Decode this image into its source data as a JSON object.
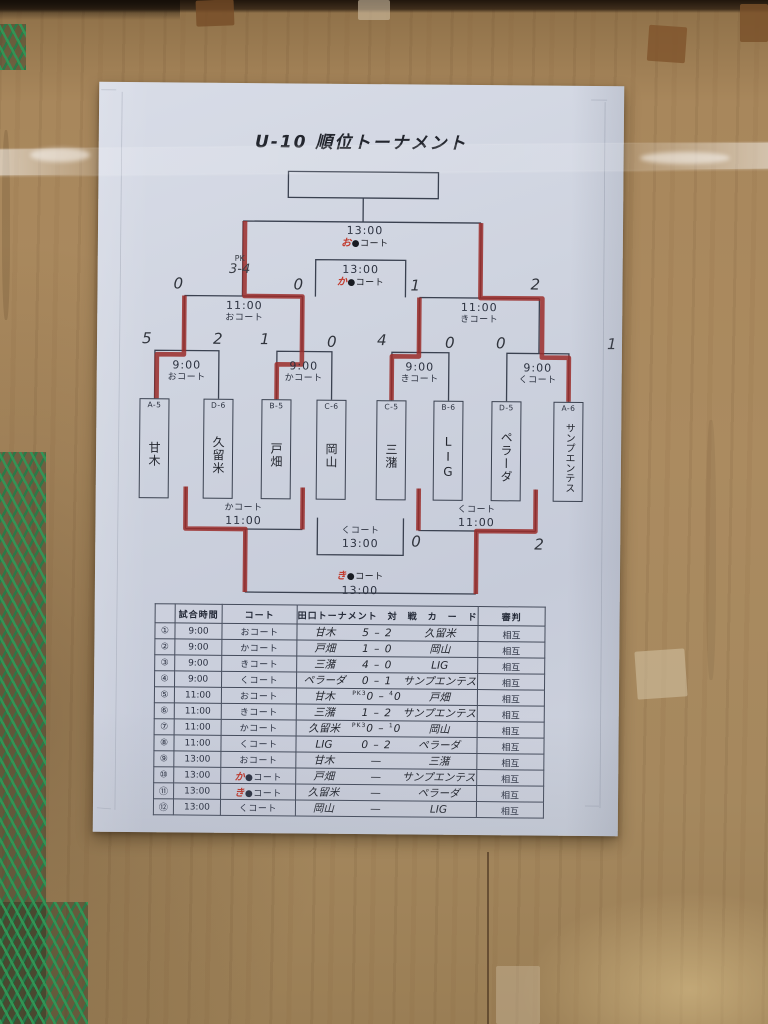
{
  "title": "U-10  順位トーナメント",
  "bracket": {
    "final": {
      "time": "13:00",
      "court_red": "お",
      "court_rest": "●コート"
    },
    "third_place": {
      "time": "13:00",
      "court_red": "か",
      "court_rest": "●コート"
    },
    "semi_left": {
      "time": "11:00",
      "court": "おコート",
      "score_left": "0",
      "score_right": "0",
      "pk_line1": "PK",
      "pk_line2": "3-4"
    },
    "semi_right": {
      "time": "11:00",
      "court": "きコート",
      "score_left": "1",
      "score_right": "2"
    },
    "qf1": {
      "time": "9:00",
      "court": "おコート",
      "score_left": "5",
      "score_right": "2"
    },
    "qf2": {
      "time": "9:00",
      "court": "かコート",
      "score_left": "1",
      "score_right": "0"
    },
    "qf3": {
      "time": "9:00",
      "court": "きコート",
      "score_left": "4",
      "score_right": "0"
    },
    "qf4": {
      "time": "9:00",
      "court": "くコート",
      "score_left": "0",
      "score_right": "1"
    },
    "consolation_left": {
      "court": "かコート",
      "time": "11:00"
    },
    "consolation_right": {
      "court": "くコート",
      "time": "11:00",
      "score_left": "0",
      "score_right": "2"
    },
    "seventh_place": {
      "court": "くコート",
      "time": "13:00"
    },
    "fifth_place": {
      "court_red": "き",
      "court_rest": "●コート",
      "time": "13:00"
    },
    "teams": [
      {
        "seed": "A-5",
        "name": "甘木"
      },
      {
        "seed": "D-6",
        "name": "久留米"
      },
      {
        "seed": "B-5",
        "name": "戸畑"
      },
      {
        "seed": "C-6",
        "name": "岡山"
      },
      {
        "seed": "C-5",
        "name": "三潴"
      },
      {
        "seed": "B-6",
        "name": "LIG"
      },
      {
        "seed": "D-5",
        "name": "ペラーダ"
      },
      {
        "seed": "A-6",
        "name": "サンプエンテス"
      }
    ]
  },
  "table": {
    "headers": {
      "no": "",
      "time": "試合時間",
      "court": "コート",
      "card": "田口トーナメント　対　戦　カ　ー　ド",
      "referee": "審判"
    },
    "rows": [
      {
        "no": "①",
        "time": "9:00",
        "court_red": "",
        "court": "おコート",
        "home": "甘木",
        "pk_home": "",
        "score_home": "5",
        "score_away": "2",
        "pk_away": "",
        "away": "久留米",
        "referee": "相互"
      },
      {
        "no": "②",
        "time": "9:00",
        "court_red": "",
        "court": "かコート",
        "home": "戸畑",
        "pk_home": "",
        "score_home": "1",
        "score_away": "0",
        "pk_away": "",
        "away": "岡山",
        "referee": "相互"
      },
      {
        "no": "③",
        "time": "9:00",
        "court_red": "",
        "court": "きコート",
        "home": "三潴",
        "pk_home": "",
        "score_home": "4",
        "score_away": "0",
        "pk_away": "",
        "away": "LIG",
        "referee": "相互"
      },
      {
        "no": "④",
        "time": "9:00",
        "court_red": "",
        "court": "くコート",
        "home": "ペラーダ",
        "pk_home": "",
        "score_home": "0",
        "score_away": "1",
        "pk_away": "",
        "away": "サンプエンテス",
        "referee": "相互"
      },
      {
        "no": "⑤",
        "time": "11:00",
        "court_red": "",
        "court": "おコート",
        "home": "甘木",
        "pk_home": "PK3",
        "score_home": "0",
        "score_away": "0",
        "pk_away": "4",
        "away": "戸畑",
        "referee": "相互"
      },
      {
        "no": "⑥",
        "time": "11:00",
        "court_red": "",
        "court": "きコート",
        "home": "三潴",
        "pk_home": "",
        "score_home": "1",
        "score_away": "2",
        "pk_away": "",
        "away": "サンプエンテス",
        "referee": "相互"
      },
      {
        "no": "⑦",
        "time": "11:00",
        "court_red": "",
        "court": "かコート",
        "home": "久留米",
        "pk_home": "PK3",
        "score_home": "0",
        "score_away": "0",
        "pk_away": "1",
        "away": "岡山",
        "referee": "相互"
      },
      {
        "no": "⑧",
        "time": "11:00",
        "court_red": "",
        "court": "くコート",
        "home": "LIG",
        "pk_home": "",
        "score_home": "0",
        "score_away": "2",
        "pk_away": "",
        "away": "ペラーダ",
        "referee": "相互"
      },
      {
        "no": "⑨",
        "time": "13:00",
        "court_red": "",
        "court": "おコート",
        "home": "甘木",
        "pk_home": "",
        "score_home": "",
        "score_away": "",
        "pk_away": "",
        "away": "三潴",
        "referee": "相互"
      },
      {
        "no": "⑩",
        "time": "13:00",
        "court_red": "か",
        "court": "●コート",
        "home": "戸畑",
        "pk_home": "",
        "score_home": "",
        "score_away": "",
        "pk_away": "",
        "away": "サンプエンテス",
        "referee": "相互"
      },
      {
        "no": "⑪",
        "time": "13:00",
        "court_red": "き",
        "court": "●コート",
        "home": "久留米",
        "pk_home": "",
        "score_home": "",
        "score_away": "",
        "pk_away": "",
        "away": "ペラーダ",
        "referee": "相互"
      },
      {
        "no": "⑫",
        "time": "13:00",
        "court_red": "",
        "court": "くコート",
        "home": "岡山",
        "pk_home": "",
        "score_home": "",
        "score_away": "",
        "pk_away": "",
        "away": "LIG",
        "referee": "相互"
      }
    ]
  }
}
